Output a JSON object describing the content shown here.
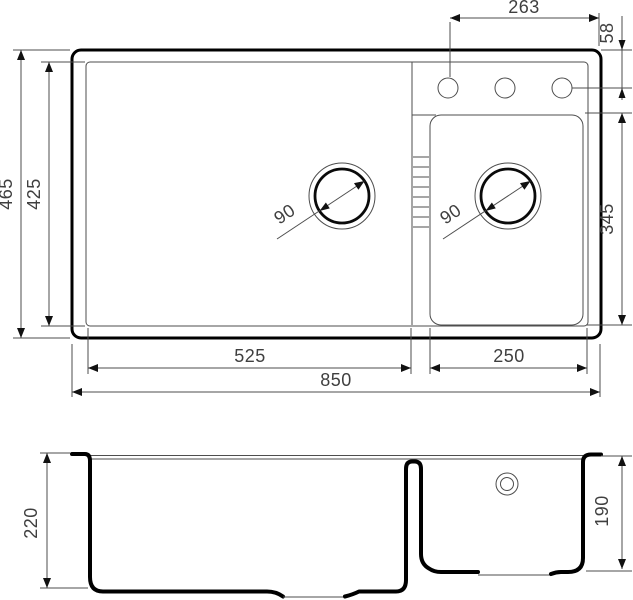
{
  "drawing": {
    "subject": "double-bowl kitchen sink technical dimension drawing",
    "units": "mm",
    "views": {
      "top": "plan view",
      "bottom": "front section view"
    },
    "colors": {
      "outline": "#000000",
      "thin_line": "#4d4d4d",
      "label_text": "#3f3f3f",
      "background": "#ffffff"
    },
    "top_view": {
      "overall_width": "850",
      "overall_depth": "465",
      "inner_rim_depth": "425",
      "main_bowl_width": "525",
      "small_bowl_width": "250",
      "small_bowl_depth": "345",
      "faucet_holes_span": "263",
      "faucet_holes_offset": "58",
      "main_drain_diameter": "90",
      "small_drain_diameter": "90",
      "faucet_hole_count": 3
    },
    "section_view": {
      "main_bowl_depth": "220",
      "small_bowl_depth": "190"
    }
  }
}
